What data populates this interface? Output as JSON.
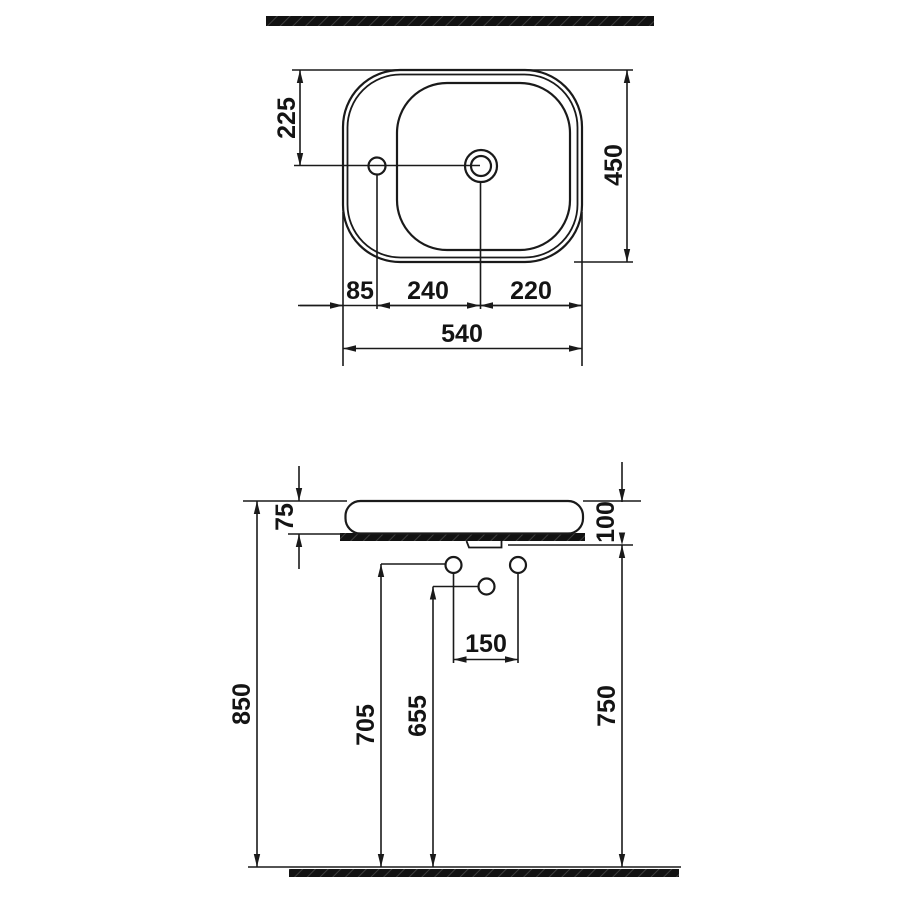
{
  "diagram": {
    "kind": "washbasin-technical-drawing",
    "views": [
      "top-view",
      "front-elevation"
    ],
    "colors": {
      "line": "#1a1a1a",
      "text": "#141414",
      "hatch": "#121212",
      "background": "#ffffff"
    }
  },
  "top_view": {
    "rim_to_holes_centerline": "225",
    "overall_depth": "450",
    "edge_to_faucet_hole": "85",
    "faucet_to_drain": "240",
    "drain_to_edge": "220",
    "overall_width": "540"
  },
  "front_view": {
    "rim_above_counter": "75",
    "rim_to_counter_underside": "100",
    "wall_hole_spacing": "150",
    "rim_height_from_floor": "850",
    "supply_holes_height": "705",
    "drain_hole_height": "655",
    "counter_underside_height": "750"
  }
}
